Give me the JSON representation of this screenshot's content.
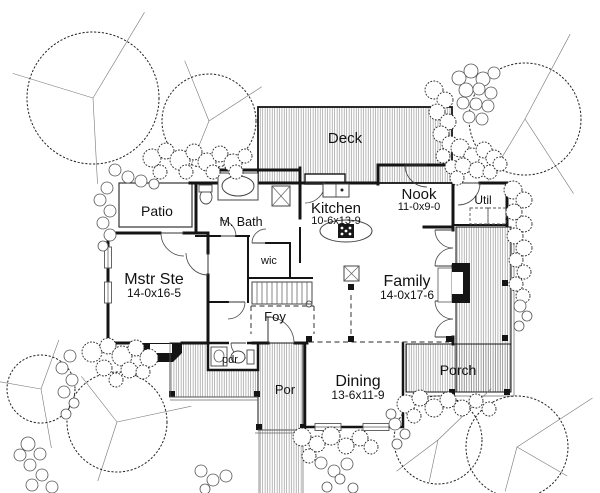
{
  "canvas": {
    "w": 600,
    "h": 493,
    "bg": "#ffffff",
    "ink": "#141414",
    "thin": "#666666",
    "hatch_line": "#7d7d7d"
  },
  "rooms": [
    {
      "id": "deck",
      "label": "Deck",
      "x": 345,
      "y": 143,
      "fs": 15
    },
    {
      "id": "patio",
      "label": "Patio",
      "x": 157,
      "y": 216,
      "fs": 14
    },
    {
      "id": "m-bath",
      "label": "M. Bath",
      "x": 241,
      "y": 226,
      "fs": 12.5
    },
    {
      "id": "kitchen",
      "label": "Kitchen",
      "dims": "10-6x13-9",
      "x": 336,
      "y": 213,
      "dy": 11,
      "fs": 15,
      "fs2": 11
    },
    {
      "id": "nook",
      "label": "Nook",
      "dims": "11-0x9-0",
      "x": 419,
      "y": 199,
      "dy": 11,
      "fs": 15,
      "fs2": 11
    },
    {
      "id": "util",
      "label": "Util",
      "x": 483,
      "y": 204,
      "fs": 12
    },
    {
      "id": "mstr-ste",
      "label": "Mstr Ste",
      "dims": "14-0x16-5",
      "x": 154,
      "y": 284,
      "dy": 13,
      "fs": 16,
      "fs2": 12
    },
    {
      "id": "wic",
      "label": "wic",
      "x": 269,
      "y": 264,
      "fs": 11
    },
    {
      "id": "foy",
      "label": "Foy",
      "x": 275,
      "y": 321,
      "fs": 13
    },
    {
      "id": "family",
      "label": "Family",
      "dims": "14-0x17-6",
      "x": 407,
      "y": 286,
      "dy": 13,
      "fs": 16,
      "fs2": 12
    },
    {
      "id": "pdr",
      "label": "pdr",
      "x": 230,
      "y": 363,
      "fs": 11
    },
    {
      "id": "por",
      "label": "Por",
      "x": 285,
      "y": 394,
      "fs": 13
    },
    {
      "id": "dining",
      "label": "Dining",
      "dims": "13-6x11-9",
      "x": 358,
      "y": 386,
      "dy": 13,
      "fs": 16,
      "fs2": 12
    },
    {
      "id": "porch",
      "label": "Porch",
      "x": 458,
      "y": 375,
      "fs": 14
    }
  ],
  "hatch_areas": [
    [
      258,
      107,
      194,
      76,
      1.8,
      "deck"
    ],
    [
      170,
      343,
      88,
      54,
      1,
      "walkway"
    ],
    [
      258,
      343,
      45,
      87,
      1,
      "por-entry"
    ],
    [
      456,
      227,
      55,
      165,
      1,
      "porch-east"
    ],
    [
      406,
      344,
      105,
      48,
      1,
      "porch-south"
    ],
    [
      259,
      430,
      44,
      63,
      0,
      "front-path"
    ]
  ],
  "patio_rect": [
    119,
    183,
    73,
    44
  ],
  "deck_step": [
    305,
    174,
    40,
    10
  ],
  "pdr_rect": [
    208,
    343,
    50,
    27
  ],
  "dining_rect": [
    305,
    342,
    98,
    85
  ],
  "walls": [
    [
      219,
      170,
      300,
      170,
      3
    ],
    [
      219,
      170,
      219,
      184,
      3
    ],
    [
      300,
      168,
      300,
      218,
      3
    ],
    [
      300,
      228,
      300,
      262,
      2
    ],
    [
      190,
      183,
      220,
      183,
      3
    ],
    [
      196,
      183,
      196,
      230,
      3
    ],
    [
      258,
      183,
      378,
      183,
      3
    ],
    [
      378,
      165,
      453,
      165,
      3
    ],
    [
      378,
      165,
      378,
      184,
      3
    ],
    [
      453,
      165,
      453,
      230,
      3
    ],
    [
      453,
      183,
      456,
      183,
      3
    ],
    [
      480,
      183,
      507,
      183,
      3
    ],
    [
      507,
      183,
      507,
      226,
      3
    ],
    [
      453,
      225,
      507,
      225,
      2
    ],
    [
      108,
      233,
      160,
      233,
      3
    ],
    [
      184,
      233,
      208,
      233,
      3
    ],
    [
      108,
      233,
      108,
      248,
      3
    ],
    [
      108,
      268,
      108,
      283,
      3
    ],
    [
      108,
      303,
      108,
      343,
      3
    ],
    [
      108,
      343,
      140,
      343,
      3
    ],
    [
      182,
      343,
      208,
      343,
      3
    ],
    [
      208,
      233,
      208,
      253,
      3
    ],
    [
      208,
      275,
      208,
      343,
      3
    ],
    [
      196,
      236,
      220,
      236,
      2
    ],
    [
      236,
      236,
      249,
      236,
      2
    ],
    [
      248,
      236,
      248,
      278,
      2
    ],
    [
      266,
      243,
      290,
      243,
      2
    ],
    [
      290,
      243,
      290,
      278,
      2
    ],
    [
      248,
      278,
      312,
      278,
      2
    ],
    [
      248,
      278,
      248,
      302,
      2
    ],
    [
      208,
      302,
      228,
      302,
      2
    ],
    [
      424,
      227,
      453,
      227,
      3
    ],
    [
      453,
      266,
      453,
      301,
      3
    ],
    [
      453,
      337,
      453,
      344,
      3
    ],
    [
      253,
      343,
      268,
      343,
      3
    ],
    [
      295,
      343,
      307,
      343,
      3
    ]
  ],
  "windows": [
    [
      104.5,
      247,
      7,
      21
    ],
    [
      104.5,
      282,
      7,
      21
    ],
    [
      315,
      423.5,
      26,
      7
    ],
    [
      363,
      423.5,
      26,
      7
    ]
  ],
  "doors": [
    [
      268,
      343,
      26,
      -90,
      0,
      1
    ],
    [
      184,
      233,
      23,
      180,
      90,
      0
    ],
    [
      208,
      253,
      22,
      90,
      180,
      1
    ],
    [
      220,
      236,
      16,
      0,
      -90,
      0
    ],
    [
      266,
      243,
      14,
      180,
      270,
      1
    ],
    [
      427,
      165,
      22,
      180,
      90,
      0
    ],
    [
      305,
      183,
      20,
      0,
      90,
      1
    ],
    [
      458,
      183,
      22,
      0,
      90,
      1
    ],
    [
      453,
      230,
      18,
      180,
      90,
      0
    ],
    [
      453,
      266,
      18,
      180,
      270,
      1
    ],
    [
      453,
      301,
      18,
      180,
      90,
      0
    ],
    [
      453,
      337,
      18,
      180,
      270,
      1
    ],
    [
      246,
      343,
      15,
      180,
      90,
      0
    ],
    [
      228,
      302,
      17,
      0,
      90,
      1
    ]
  ],
  "door_gaps": [
    [
      229,
      340.5,
      18,
      5
    ]
  ],
  "dashed_lines": [
    [
      251,
      306,
      314,
      306
    ],
    [
      314,
      306,
      314,
      334
    ],
    [
      251,
      306,
      251,
      334
    ],
    [
      351,
      295,
      351,
      336
    ],
    [
      309,
      342,
      449,
      342
    ]
  ],
  "posts": [
    [
      172,
      394
    ],
    [
      257,
      394
    ],
    [
      259,
      427
    ],
    [
      303,
      427
    ],
    [
      309,
      339
    ],
    [
      351,
      339
    ],
    [
      449,
      339
    ],
    [
      351,
      287
    ],
    [
      452,
      392
    ],
    [
      507,
      392
    ],
    [
      505,
      283
    ],
    [
      505,
      338
    ]
  ],
  "thin_lines": [
    [
      170,
      397,
      258,
      397
    ],
    [
      170,
      400,
      258,
      400
    ],
    [
      170,
      343,
      170,
      397
    ],
    [
      258,
      430,
      303,
      430
    ],
    [
      255,
      433,
      306,
      433
    ],
    [
      403,
      396,
      514,
      396
    ],
    [
      514,
      227,
      514,
      396
    ],
    [
      259,
      430,
      259,
      493
    ],
    [
      303,
      430,
      303,
      493
    ]
  ],
  "black_shapes": {
    "bay_window": "140,343 182,343 182,353 173,362 149,362 140,353",
    "bay_notch": [
      150,
      344,
      22,
      9
    ],
    "fireplace": [
      452,
      263,
      18,
      40
    ],
    "fireplace_notch": [
      452,
      272,
      11,
      22
    ],
    "hearth": [
      438,
      268,
      14,
      34
    ]
  },
  "fixtures": {
    "tub": [
      218,
      173,
      40,
      27
    ],
    "tub_oval": [
      238,
      186,
      16,
      10
    ],
    "shower": [
      272,
      186,
      18,
      20
    ],
    "toilet_bath": {
      "oval": [
        206,
        197,
        6,
        7
      ],
      "tank": [
        199,
        185,
        13,
        7
      ]
    },
    "toilet_pdr": {
      "oval": [
        238,
        357,
        7,
        6
      ],
      "tank": [
        247,
        350,
        7,
        14
      ]
    },
    "sink_pdr": {
      "box": [
        211,
        347,
        16,
        19
      ],
      "oval": [
        219,
        356,
        5,
        6
      ]
    },
    "range": [
      323,
      184,
      26,
      13
    ],
    "island": [
      346,
      231,
      26,
      11
    ],
    "cooktop": [
      338,
      224,
      16,
      14
    ],
    "column_x": [
      344,
      266,
      15,
      15
    ],
    "stairs": {
      "x": 252,
      "y": 282,
      "w": 60,
      "h": 22,
      "step": 5,
      "rail_end": [
        309,
        304,
        3
      ]
    },
    "util_units": [
      [
        470,
        208,
        18,
        16
      ],
      [
        488,
        208,
        18,
        16
      ]
    ]
  },
  "trees": [
    {
      "cx": 93,
      "cy": 98,
      "r": 66,
      "lines": [
        [
          -59,
          100
        ],
        [
          197,
          84
        ],
        [
          87,
          86
        ]
      ]
    },
    {
      "cx": 209,
      "cy": 121,
      "r": 47,
      "lines": [
        [
          -112,
          65
        ],
        [
          -33,
          63
        ],
        [
          112,
          57
        ]
      ]
    },
    {
      "cx": 525,
      "cy": 119,
      "r": 56,
      "lines": [
        [
          -62,
          96
        ],
        [
          57,
          89
        ],
        [
          121,
          72
        ]
      ]
    },
    {
      "cx": 41,
      "cy": 389,
      "r": 34,
      "lines": [
        [
          -70,
          52
        ],
        [
          190,
          44
        ],
        [
          80,
          60
        ]
      ]
    },
    {
      "cx": 117,
      "cy": 422,
      "r": 50,
      "lines": [
        [
          -128,
          58
        ],
        [
          -12,
          76
        ],
        [
          108,
          62
        ]
      ]
    },
    {
      "cx": 438,
      "cy": 440,
      "r": 44,
      "lines": [
        [
          -44,
          74
        ],
        [
          143,
          52
        ],
        [
          102,
          43
        ]
      ]
    },
    {
      "cx": 517,
      "cy": 447,
      "r": 51,
      "lines": [
        [
          -33,
          90
        ],
        [
          30,
          58
        ],
        [
          105,
          46
        ]
      ]
    }
  ],
  "bushes": [
    [
      152,
      158,
      9
    ],
    [
      166,
      151,
      8
    ],
    [
      180,
      160,
      10
    ],
    [
      194,
      152,
      8
    ],
    [
      207,
      162,
      9
    ],
    [
      220,
      154,
      8
    ],
    [
      233,
      163,
      9
    ],
    [
      245,
      156,
      7
    ],
    [
      160,
      172,
      7
    ],
    [
      186,
      172,
      7
    ],
    [
      213,
      172,
      7
    ],
    [
      236,
      172,
      7
    ],
    [
      434,
      90,
      9
    ],
    [
      445,
      100,
      8
    ],
    [
      437,
      112,
      8
    ],
    [
      448,
      122,
      8
    ],
    [
      441,
      134,
      8
    ],
    [
      450,
      144,
      8
    ],
    [
      443,
      156,
      7
    ],
    [
      452,
      167,
      7
    ],
    [
      460,
      148,
      9
    ],
    [
      472,
      156,
      8
    ],
    [
      484,
      150,
      8
    ],
    [
      494,
      158,
      8
    ],
    [
      463,
      166,
      8
    ],
    [
      477,
      170,
      8
    ],
    [
      490,
      172,
      7
    ],
    [
      500,
      164,
      7
    ],
    [
      457,
      178,
      7
    ],
    [
      513,
      190,
      9
    ],
    [
      524,
      200,
      8
    ],
    [
      514,
      212,
      8
    ],
    [
      524,
      224,
      8
    ],
    [
      515,
      236,
      8
    ],
    [
      524,
      248,
      8
    ],
    [
      516,
      260,
      7
    ],
    [
      524,
      272,
      7
    ],
    [
      516,
      284,
      7
    ],
    [
      523,
      296,
      7
    ],
    [
      92,
      352,
      10
    ],
    [
      108,
      346,
      8
    ],
    [
      122,
      356,
      10
    ],
    [
      136,
      348,
      8
    ],
    [
      149,
      358,
      9
    ],
    [
      104,
      368,
      8
    ],
    [
      129,
      370,
      8
    ],
    [
      143,
      372,
      7
    ],
    [
      116,
      380,
      7
    ],
    [
      302,
      437,
      9
    ],
    [
      317,
      444,
      8
    ],
    [
      331,
      436,
      9
    ],
    [
      346,
      446,
      8
    ],
    [
      360,
      438,
      8
    ],
    [
      309,
      456,
      7
    ],
    [
      371,
      447,
      7
    ],
    [
      406,
      404,
      9
    ],
    [
      420,
      398,
      8
    ],
    [
      434,
      408,
      9
    ],
    [
      448,
      400,
      8
    ],
    [
      462,
      408,
      8
    ],
    [
      476,
      401,
      7
    ],
    [
      489,
      409,
      7
    ],
    [
      414,
      416,
      7
    ]
  ],
  "stones": [
    [
      107,
      188,
      6
    ],
    [
      100,
      200,
      6
    ],
    [
      110,
      211,
      6
    ],
    [
      103,
      223,
      6
    ],
    [
      110,
      235,
      6
    ],
    [
      103,
      246,
      5
    ],
    [
      115,
      170,
      6
    ],
    [
      128,
      177,
      6
    ],
    [
      141,
      181,
      6
    ],
    [
      154,
      184,
      5
    ],
    [
      459,
      78,
      7
    ],
    [
      471,
      71,
      7
    ],
    [
      483,
      79,
      7
    ],
    [
      494,
      73,
      6
    ],
    [
      466,
      90,
      7
    ],
    [
      479,
      89,
      6
    ],
    [
      491,
      93,
      6
    ],
    [
      463,
      103,
      6
    ],
    [
      476,
      104,
      6
    ],
    [
      488,
      106,
      6
    ],
    [
      469,
      117,
      6
    ],
    [
      482,
      119,
      6
    ],
    [
      520,
      306,
      6
    ],
    [
      527,
      316,
      5
    ],
    [
      519,
      326,
      5
    ],
    [
      70,
      356,
      6
    ],
    [
      62,
      368,
      6
    ],
    [
      72,
      380,
      6
    ],
    [
      64,
      392,
      6
    ],
    [
      74,
      403,
      5
    ],
    [
      66,
      414,
      5
    ],
    [
      28,
      444,
      7
    ],
    [
      40,
      454,
      6
    ],
    [
      30,
      465,
      6
    ],
    [
      42,
      475,
      6
    ],
    [
      32,
      485,
      6
    ],
    [
      20,
      455,
      6
    ],
    [
      52,
      487,
      6
    ],
    [
      321,
      463,
      6
    ],
    [
      334,
      471,
      6
    ],
    [
      347,
      464,
      6
    ],
    [
      340,
      479,
      5
    ],
    [
      327,
      487,
      5
    ],
    [
      353,
      488,
      5
    ],
    [
      201,
      471,
      6
    ],
    [
      213,
      480,
      6
    ],
    [
      205,
      489,
      5
    ],
    [
      226,
      476,
      6
    ],
    [
      395,
      424,
      6
    ],
    [
      405,
      434,
      5
    ],
    [
      397,
      444,
      5
    ],
    [
      391,
      414,
      5
    ]
  ]
}
